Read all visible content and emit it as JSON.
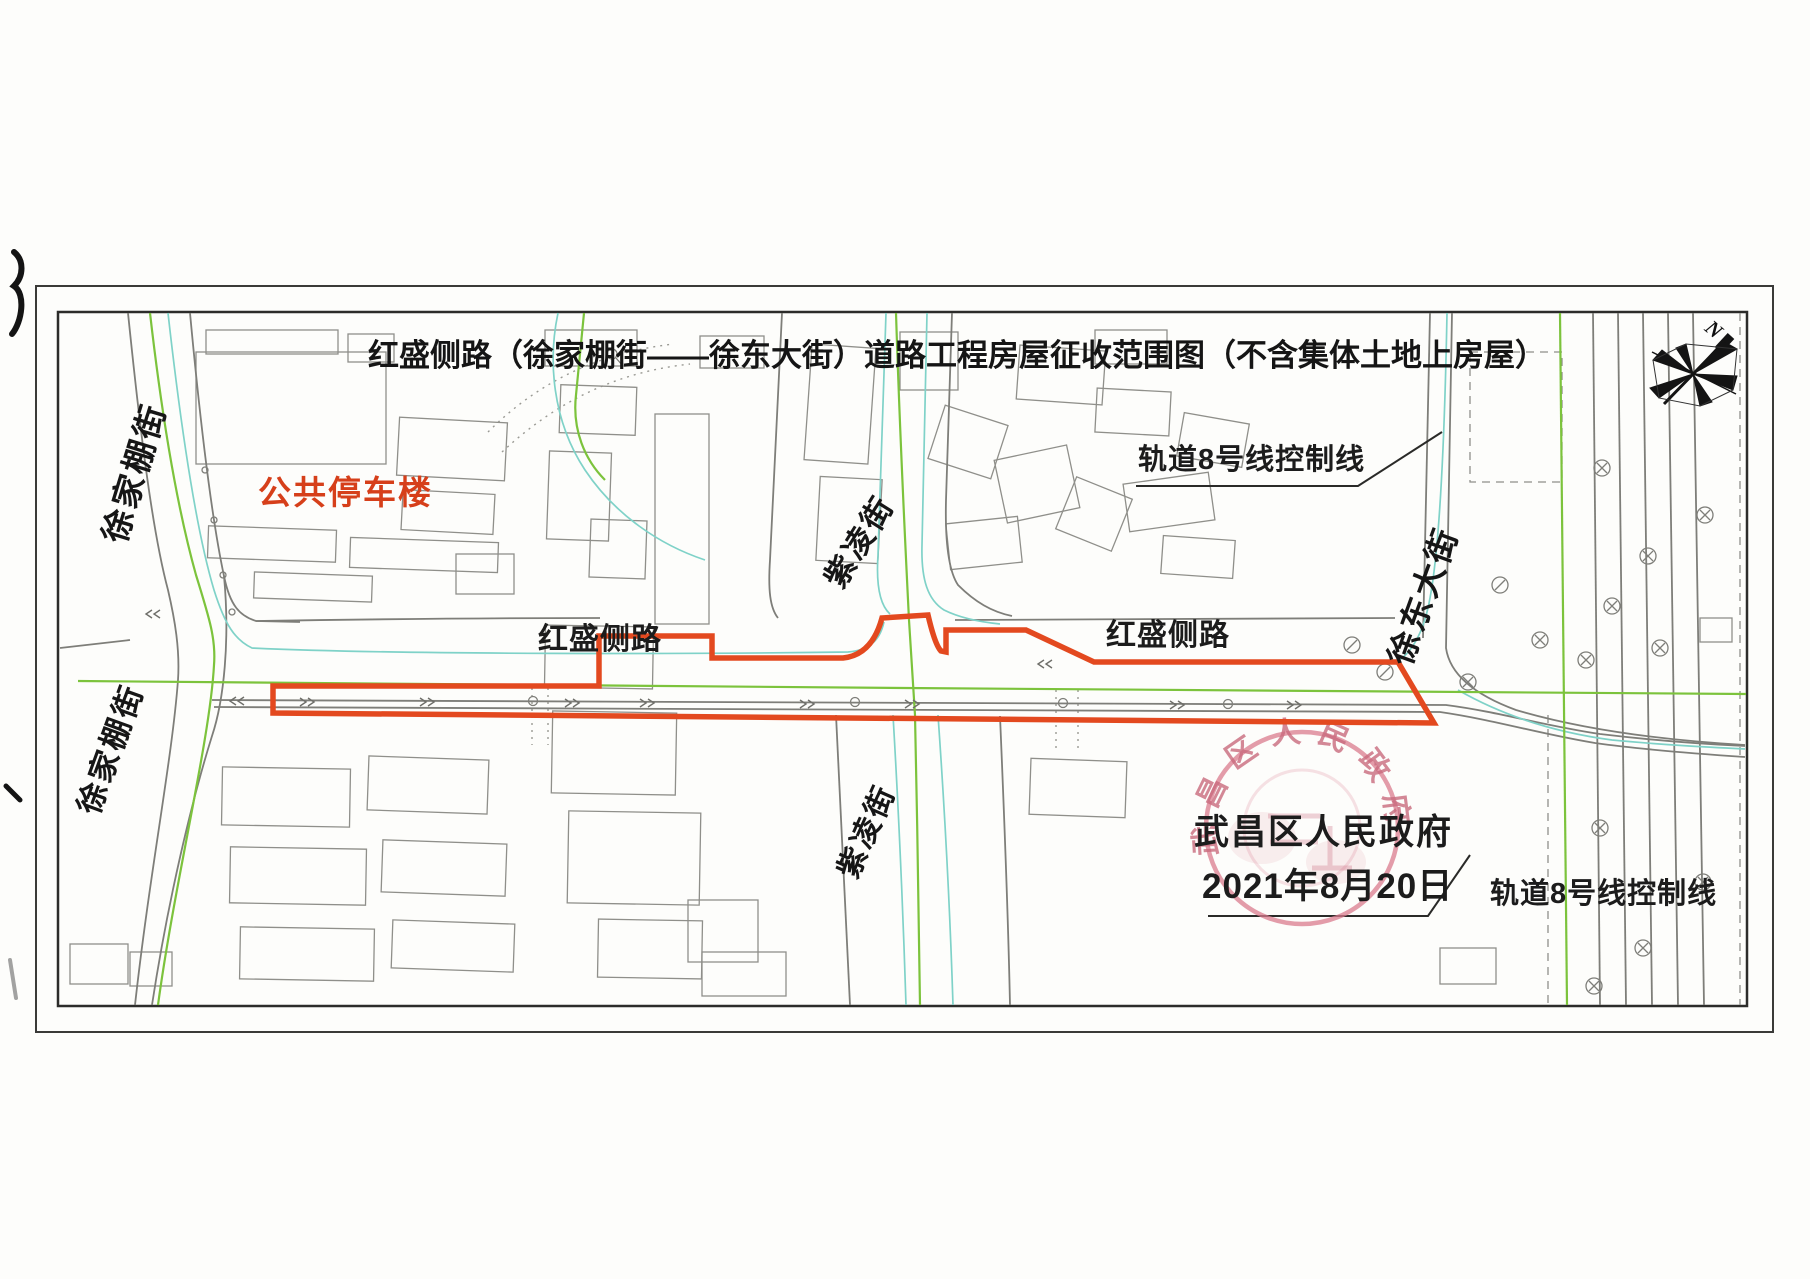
{
  "title": "红盛侧路（徐家棚街——徐东大街）道路工程房屋征收范围图（不含集体土地上房屋）",
  "compass": {
    "north_label": "N"
  },
  "street_labels": {
    "xujiapeng_upper": "徐家棚街",
    "xujiapeng_lower": "徐家棚街",
    "ziling_upper": "紫凌街",
    "ziling_lower": "紫凌街",
    "hongsheng_left": "红盛侧路",
    "hongsheng_right": "红盛侧路",
    "xudong": "徐东大街"
  },
  "area_labels": {
    "public_parking": "公共停车楼",
    "rail_control_top": "轨道8号线控制线",
    "rail_control_bottom": "轨道8号线控制线"
  },
  "approval": {
    "authority": "武昌区人民政府",
    "date": "2021年8月20日"
  },
  "stamp": {
    "arc_text": "武昌区人民政府"
  },
  "colors": {
    "boundary_orange": "#e3491f",
    "parking_label_orange": "#d63f1a",
    "centerline_green": "#7cc33c",
    "utility_cyan": "#7fd2c8",
    "road_gray": "#7e7e79",
    "building_gray": "#8f8f8a",
    "stamp_red": "#d97b8d",
    "text_black": "#1c1c1c"
  }
}
